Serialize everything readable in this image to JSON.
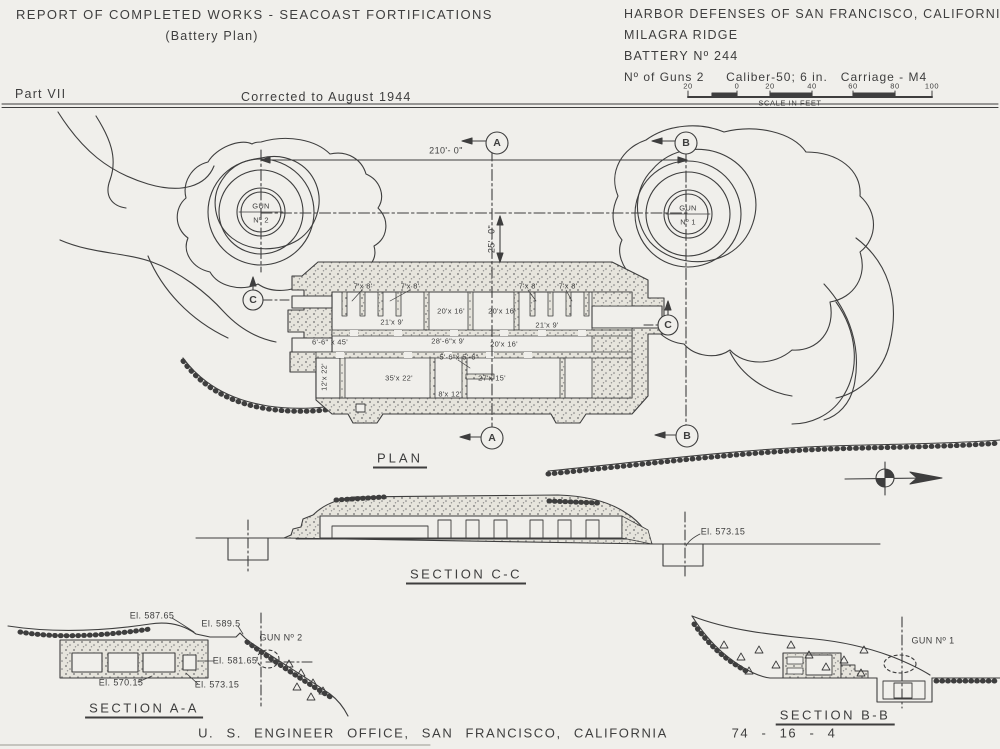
{
  "colors": {
    "paper": "#f0efeb",
    "ink": "#3e3e3e"
  },
  "header": {
    "title": "REPORT OF COMPLETED WORKS - SEACOAST FORTIFICATIONS",
    "subtitle": "(Battery Plan)",
    "agency": "HARBOR DEFENSES OF SAN FRANCISCO, CALIFORNIA",
    "site": "MILAGRA RIDGE",
    "battery": "BATTERY Nº 244",
    "guns": "Nº of Guns 2     Caliber-50; 6 in.   Carriage - M4",
    "part": "Part VII",
    "corrected": "Corrected to August 1944",
    "scale": {
      "ticks": [
        "20",
        "0",
        "20",
        "40",
        "60",
        "80",
        "100"
      ],
      "caption": "SCALE IN FEET"
    }
  },
  "plan": {
    "title": "PLAN",
    "gun1_line1": "GUN",
    "gun1_line2": "Nº 1",
    "gun2_line1": "GUN",
    "gun2_line2": "Nº 2",
    "dim_spacing": "210'- 0\"",
    "dim_offset": "25'- 0\"",
    "marker_a": "A",
    "marker_b": "B",
    "marker_c": "C",
    "rooms": [
      {
        "label": "7'x 8'"
      },
      {
        "label": "7'x 8'"
      },
      {
        "label": "21'x 9'"
      },
      {
        "label": "20'x 16'"
      },
      {
        "label": "20'x 16'"
      },
      {
        "label": "7'x 8'"
      },
      {
        "label": "7'x 8'"
      },
      {
        "label": "21'x 9'"
      },
      {
        "label": "6'-6\" x 45'"
      },
      {
        "label": "28'-6\"x 9'"
      },
      {
        "label": "20'x 16'"
      },
      {
        "label": "5'-6\"x 5'-6\""
      },
      {
        "label": "12'x 22'"
      },
      {
        "label": "35'x 22'"
      },
      {
        "label": "8'x 12'"
      },
      {
        "label": "27'x 15'"
      }
    ]
  },
  "sections": {
    "cc": {
      "title": "SECTION C-C",
      "elevation": "El. 573.15"
    },
    "aa": {
      "title": "SECTION A-A",
      "gun": "GUN Nº 2",
      "el1": "El. 587.65",
      "el2": "El. 589.5",
      "el3": "El. 581.65",
      "el4": "El. 570.15",
      "el5": "El. 573.15"
    },
    "bb": {
      "title": "SECTION B-B",
      "gun": "GUN Nº 1"
    }
  },
  "footer": {
    "office": "U. S. ENGINEER OFFICE, SAN FRANCISCO, CALIFORNIA",
    "number": "74 - 16 - 4"
  }
}
